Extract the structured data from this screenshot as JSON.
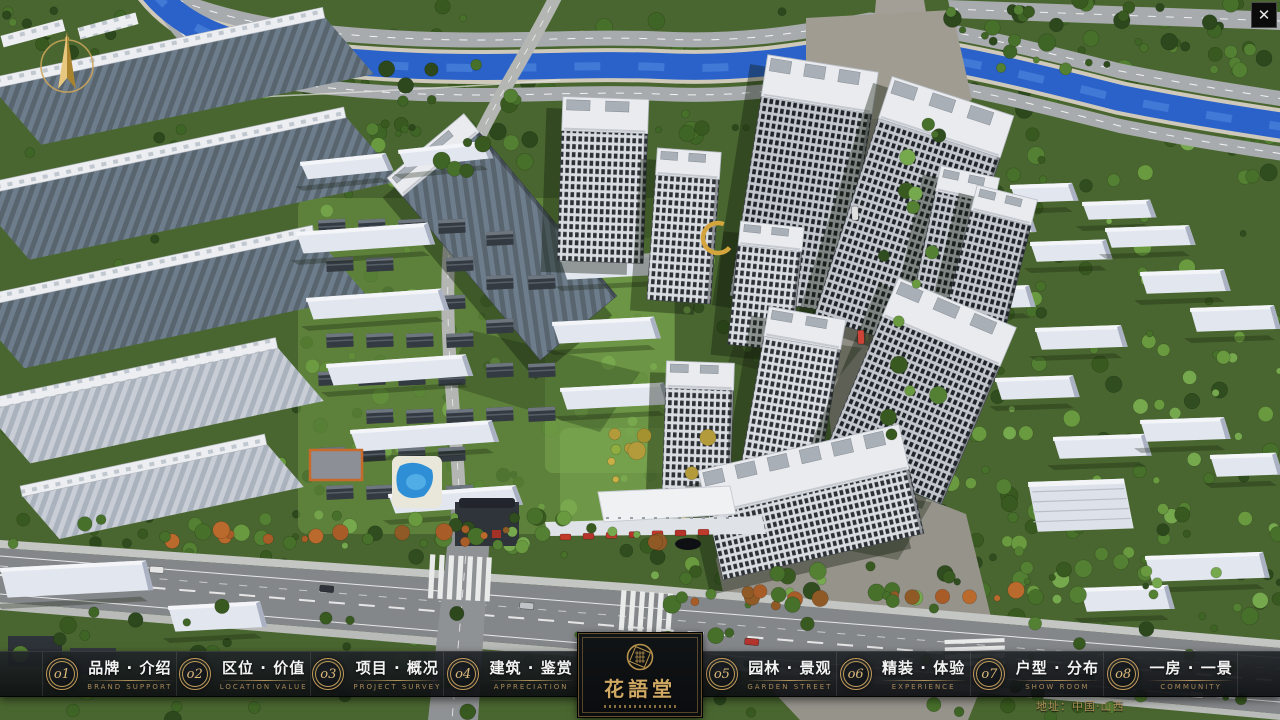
{
  "window": {
    "close_label": "✕"
  },
  "nav": {
    "items": [
      {
        "num": "o1",
        "cn": "品牌 · 介绍",
        "en": "BRAND SUPPORT"
      },
      {
        "num": "o2",
        "cn": "区位 · 价值",
        "en": "LOCATION VALUE"
      },
      {
        "num": "o3",
        "cn": "项目 · 概况",
        "en": "PROJECT SURVEY"
      },
      {
        "num": "o4",
        "cn": "建筑 · 鉴赏",
        "en": "APPRECIATION"
      },
      {
        "num": "o5",
        "cn": "园林 · 景观",
        "en": "GARDEN STREET"
      },
      {
        "num": "o6",
        "cn": "精装 · 体验",
        "en": "EXPERIENCE"
      },
      {
        "num": "o7",
        "cn": "户型 · 分布",
        "en": "SHOW ROOM"
      },
      {
        "num": "o8",
        "cn": "一房 · 一景",
        "en": "COMMUNITY"
      }
    ]
  },
  "logo": {
    "title": "花語堂"
  },
  "footer": {
    "address": "地址：中国·山西"
  },
  "colors": {
    "gold": "#c9a35c",
    "bar_bg": "#14171a",
    "river": "#2a62c9",
    "accent_text": "#a8895a"
  }
}
